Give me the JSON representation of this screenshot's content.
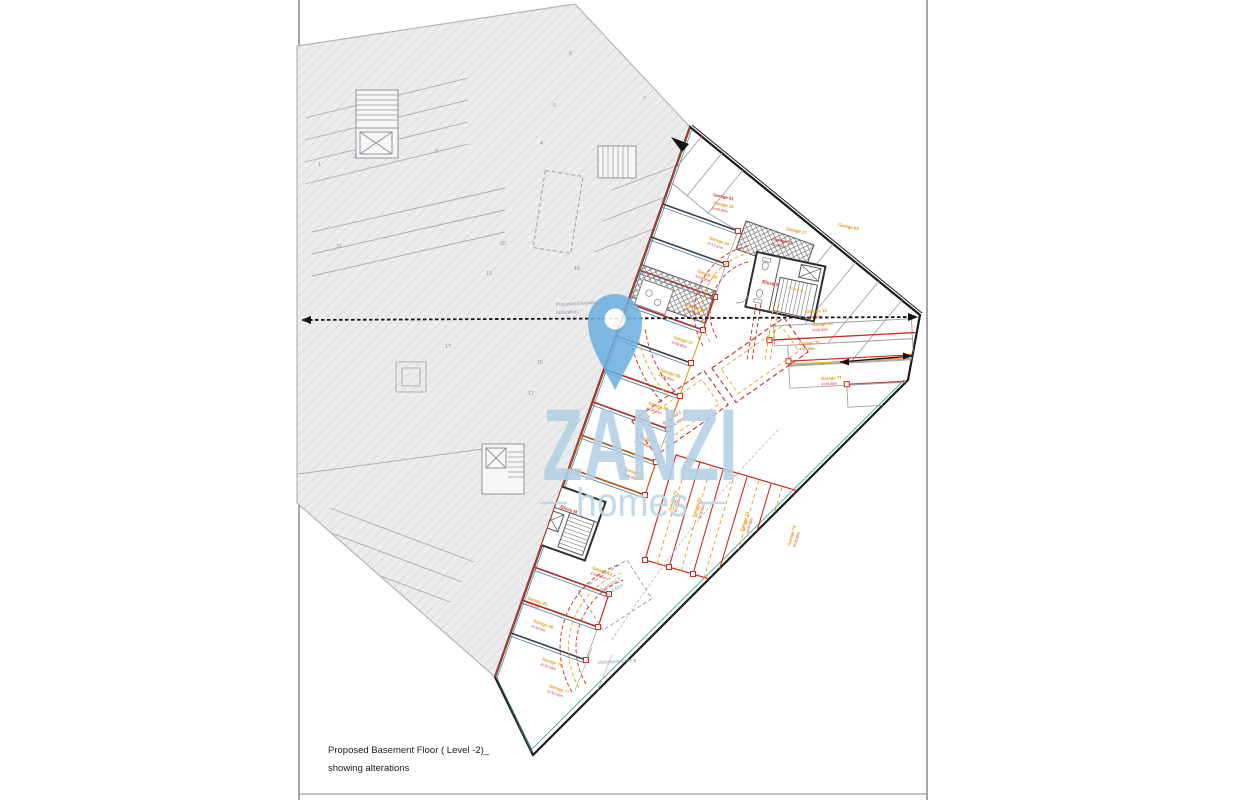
{
  "title_block": {
    "line1": "Proposed Basement Floor ( Level -2)_",
    "line2": "showing alterations"
  },
  "watermark": {
    "brand": "ZANZI",
    "sub": "homes",
    "pin_color": "#6fb0df",
    "text_color": "#b3d0e5"
  },
  "annotations": {
    "substation_line1": "Proposed Enemalta",
    "substation_line2": "Substation",
    "motorcycle": "Motorcycle parking",
    "reserved5": "Reserved 5",
    "reserved5_dim": "5.00×4.60m",
    "reserved2": "Reserved 2",
    "reserved2_dim": "3.85×4.60m",
    "block_n": "Block N",
    "room_a": "Room A",
    "block_m": "Block M"
  },
  "garage_labels": [
    {
      "label": "Garage 01",
      "dim": "",
      "x": 713,
      "y": 196,
      "rot": 12,
      "c": "red"
    },
    {
      "label": "Garage 16",
      "dim": "4×08.85m",
      "x": 713,
      "y": 204,
      "rot": 12,
      "c": "orange"
    },
    {
      "label": "Garage 17",
      "dim": "",
      "x": 786,
      "y": 230,
      "rot": 12,
      "c": "orange"
    },
    {
      "label": "Garage 02",
      "dim": "4×08.85m",
      "x": 772,
      "y": 240,
      "rot": 12,
      "c": "red"
    },
    {
      "label": "Garage 03",
      "dim": "",
      "x": 838,
      "y": 226,
      "rot": 12,
      "c": "orange"
    },
    {
      "label": "Garage 04",
      "dim": "4×17.67m",
      "x": 709,
      "y": 239,
      "rot": 19.5,
      "c": "orange"
    },
    {
      "label": "Garage 05",
      "dim": "4×08.85m",
      "x": 697,
      "y": 272,
      "rot": 19.5,
      "c": "orange"
    },
    {
      "label": "Garage 06",
      "dim": "4×08.85m",
      "x": 685,
      "y": 305,
      "rot": 19.5,
      "c": "orange"
    },
    {
      "label": "Garage 07",
      "dim": "4×08.85m",
      "x": 673,
      "y": 338,
      "rot": 19.5,
      "c": "orange"
    },
    {
      "label": "Garage 08",
      "dim": "4×08.85m",
      "x": 660,
      "y": 371,
      "rot": 19.5,
      "c": "orange"
    },
    {
      "label": "Garage 09",
      "dim": "4×08.85m",
      "x": 648,
      "y": 404,
      "rot": 19.5,
      "c": "orange"
    },
    {
      "label": "Garage 10",
      "dim": "4×08.85m",
      "x": 636,
      "y": 437,
      "rot": 19.5,
      "c": "orange"
    },
    {
      "label": "Garage 11",
      "dim": "4×08.85m",
      "x": 624,
      "y": 470,
      "rot": 19.5,
      "c": "orange"
    },
    {
      "label": "Garage 12",
      "dim": "4×08.85m",
      "x": 592,
      "y": 569,
      "rot": 19.5,
      "c": "orange"
    },
    {
      "label": "Garage 45",
      "dim": "4×10.5m",
      "x": 527,
      "y": 599,
      "rot": 19.5,
      "c": "orange"
    },
    {
      "label": "Garage 46",
      "dim": "4×10.5m",
      "x": 533,
      "y": 622,
      "rot": 19.5,
      "c": "orange"
    },
    {
      "label": "Garage 76",
      "dim": "4×10.56m",
      "x": 542,
      "y": 660,
      "rot": 19.5,
      "c": "orange"
    },
    {
      "label": "Garage 77",
      "dim": "6×10.56m",
      "x": 549,
      "y": 687,
      "rot": 19.5,
      "c": "orange"
    },
    {
      "label": "Garage 13",
      "dim": "4×08.85m",
      "x": 806,
      "y": 313,
      "rot": -3,
      "c": "orange"
    },
    {
      "label": "Garage 14",
      "dim": "4×08.85m",
      "x": 812,
      "y": 326,
      "rot": -3,
      "c": "orange"
    },
    {
      "label": "Garage 70",
      "dim": "4×08.85m",
      "x": 799,
      "y": 345,
      "rot": -3,
      "c": "orange"
    },
    {
      "label": "Garage 71",
      "dim": "4×08.85m",
      "x": 821,
      "y": 380,
      "rot": -3,
      "c": "orange"
    },
    {
      "label": "Garage 75",
      "dim": "4×08.85m",
      "x": 671,
      "y": 511,
      "rot": -73,
      "c": "orange"
    },
    {
      "label": "Garage 72",
      "dim": "4×08.85m",
      "x": 695,
      "y": 518,
      "rot": -73,
      "c": "orange"
    },
    {
      "label": "Garage 73",
      "dim": "4×08.85m",
      "x": 743,
      "y": 532,
      "rot": -73,
      "c": "orange"
    },
    {
      "label": "Garage 74",
      "dim": "4×08.85m",
      "x": 790,
      "y": 546,
      "rot": -73,
      "c": "orange"
    }
  ],
  "existing_numbers": [
    {
      "n": "1",
      "x": 318,
      "y": 166
    },
    {
      "n": "2",
      "x": 353,
      "y": 158
    },
    {
      "n": "3",
      "x": 435,
      "y": 153
    },
    {
      "n": "4",
      "x": 540,
      "y": 145
    },
    {
      "n": "5",
      "x": 553,
      "y": 107
    },
    {
      "n": "6",
      "x": 569,
      "y": 55
    },
    {
      "n": "7",
      "x": 643,
      "y": 100
    },
    {
      "n": "21",
      "x": 336,
      "y": 248
    },
    {
      "n": "20",
      "x": 500,
      "y": 245
    },
    {
      "n": "19",
      "x": 486,
      "y": 275
    },
    {
      "n": "16",
      "x": 574,
      "y": 270
    },
    {
      "n": "17",
      "x": 445,
      "y": 348
    },
    {
      "n": "15",
      "x": 537,
      "y": 364
    },
    {
      "n": "12",
      "x": 528,
      "y": 395
    }
  ],
  "colors": {
    "existing_hatch": "#ececec",
    "existing_walls": "#a8adb2",
    "proposed_boundary": "#1c1c1c",
    "alteration_red": "#c92a22",
    "alteration_orange": "#e8960a",
    "divider_teal": "#2f9a93",
    "divider_steel": "#4d7fa6",
    "watermark_blue": "#b3d0e5"
  }
}
